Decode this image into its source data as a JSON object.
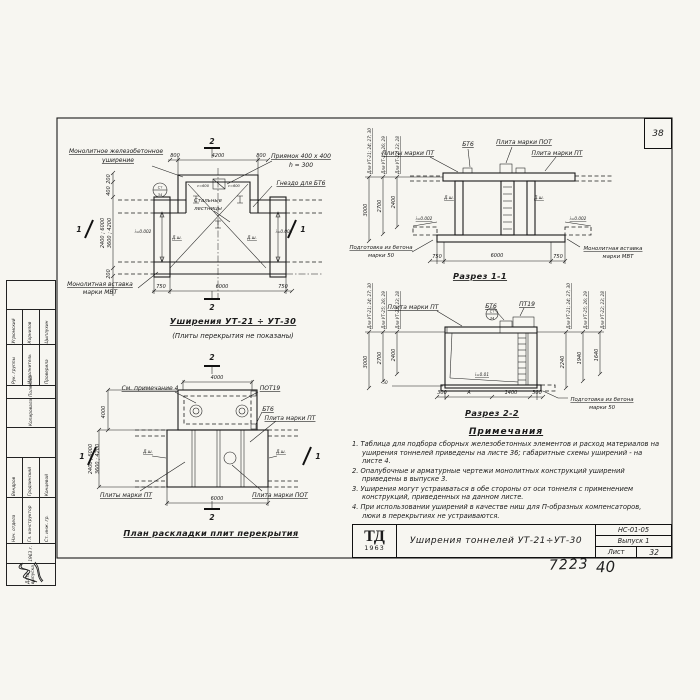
{
  "sheet": {
    "corner_number": "38",
    "hand_left": "7223",
    "hand_right": "40"
  },
  "plan": {
    "title": "Уширения УТ-21 ÷ УТ-30",
    "subtitle": "(Плиты перекрытия не показаны)",
    "widening_l1": "Монолитное железобетонное",
    "widening_l2": "уширение",
    "pit_l1": "Приямок 400 x 400",
    "pit_l2": "h = 300",
    "socket": "Гнездо для БТ6",
    "ladders_l1": "Стальные",
    "ladders_l2": "лестницы",
    "insert_l1": "Монолитная вставка",
    "insert_l2": "марки МВТ",
    "slope_left": "i=0.002",
    "slope_right": "i=0.002",
    "joint_left": "Д.ш.",
    "joint_right": "Д.ш.",
    "pit_note_left": "с=600",
    "pit_note_right": "с=600",
    "detail_top": "Ст",
    "detail_bot": "34",
    "dim_top": [
      "800",
      "4200",
      "800"
    ],
    "dim_bottom": [
      "750",
      "6000",
      "750"
    ],
    "dim_left_1": "200",
    "dim_left_2": "400",
    "dim_left_span1": "2400 ; 6000",
    "dim_left_span2": "3600 ; 4200",
    "dim_left_3": "200",
    "mark_top": "2",
    "mark_bottom": "2",
    "mark_left": "1",
    "mark_right": "1"
  },
  "s11": {
    "title": "Разрез 1-1",
    "bt6": "БТ6",
    "slab_pot": "Плита марки ПОТ",
    "slabs_pt": "Плиты марки ПТ",
    "slab_pt": "Плита марки ПТ",
    "joint_left": "Д.ш.",
    "joint_right": "Д.ш.",
    "slope_left": "i=0.002",
    "slope_right": "i=0.002",
    "prep_l1": "Подготовка из бетона",
    "prep_l2": "марки 50",
    "insert_l1": "Монолитная вставка",
    "insert_l2": "марки МВТ",
    "dim_bottom": [
      "750",
      "6000",
      "750"
    ],
    "h": [
      {
        "label": "Для УТ-21; 24; 27; 30",
        "value": "3000"
      },
      {
        "label": "Для УТ-25; 26; 29",
        "value": "2700"
      },
      {
        "label": "Для УТ-22; 23; 28",
        "value": "2400"
      }
    ]
  },
  "s22": {
    "title": "Разрез 2-2",
    "slab_pt": "Плита марки ПТ",
    "bt6": "БТ6",
    "pt19": "ПТ19",
    "slope": "i=0.01",
    "prep_l1": "Подготовка из бетона",
    "prep_l2": "марки 50",
    "offset": "50",
    "detail_top": "Ст",
    "detail_bot": "34",
    "dim_bottom": [
      "300",
      "А",
      "1400",
      "300"
    ],
    "hl": [
      {
        "label": "Для УТ-21; 24; 27; 30",
        "value": "3000"
      },
      {
        "label": "Для УТ-25; 26; 29",
        "value": "2700"
      },
      {
        "label": "Для УТ-22; 23; 28",
        "value": "2400"
      }
    ],
    "hr": [
      {
        "label": "Для УТ-21; 24; 27; 30",
        "value": "2240"
      },
      {
        "label": "Для УТ-25; 26; 29",
        "value": "1940"
      },
      {
        "label": "Для УТ-22; 23; 28",
        "value": "1640"
      }
    ]
  },
  "sp": {
    "title": "План раскладки плит перекрытия",
    "see_note": "См. примечание 4",
    "pot19": "ПОТ19",
    "bt6": "БТ6",
    "slab_pt": "Плита марки ПТ",
    "slabs_pt": "Плиты марки ПТ",
    "slab_pot": "Плита марки ПОТ",
    "joint_left": "Д.ш.",
    "joint_right": "Д.ш.",
    "dim_top": "4000",
    "dim_bottom": "6000",
    "dim_left": "4000",
    "dim_span1": "2400 ; 6000",
    "dim_span2": "3600 ; 4200",
    "mark_top": "2",
    "mark_bottom": "2",
    "mark_left": "1",
    "mark_right": "1"
  },
  "notes": {
    "title": "Примечания",
    "items": [
      "1. Таблица для подбора сборных железобетонных элементов и расход материалов на уширения тоннелей приведены на листе 36; габаритные схемы уширений - на листе 4.",
      "2. Опалубочные и арматурные чертежи монолитных конструкций уширений приведены в выпуске 3.",
      "3. Уширения могут устраиваться в обе стороны от оси тоннеля с применением конструкций, приведенных на данном листе.",
      "4. При использовании уширений в качестве ниш для П-образных компенсаторов, люки в перекрытиях не устраиваются."
    ]
  },
  "tb": {
    "logo": "ТД",
    "year": "1963",
    "title": "Уширения тоннелей УТ-21÷УТ-30",
    "code": "НС-01-05",
    "issue": "Выпуск 1",
    "sheet_label": "Лист",
    "sheet_value": "32"
  },
  "stamp": {
    "date_role": "Дата выпуска",
    "date_value": "1963 г.",
    "g1": [
      {
        "role": "Нач. отдела",
        "name": "Вендров"
      },
      {
        "role": "Гл. конструктор",
        "name": "Гродзинский"
      },
      {
        "role": "Ст. инж. гр.",
        "name": "Концевой"
      }
    ],
    "copy_role": "Копировала",
    "copy_name": "Полякова",
    "g2": [
      {
        "role": "Рук. группы",
        "name": "Угрюмский"
      },
      {
        "role": "Исполнитель",
        "name": "Корнилов"
      },
      {
        "role": "Проверила",
        "name": "Цыплухин"
      }
    ]
  }
}
